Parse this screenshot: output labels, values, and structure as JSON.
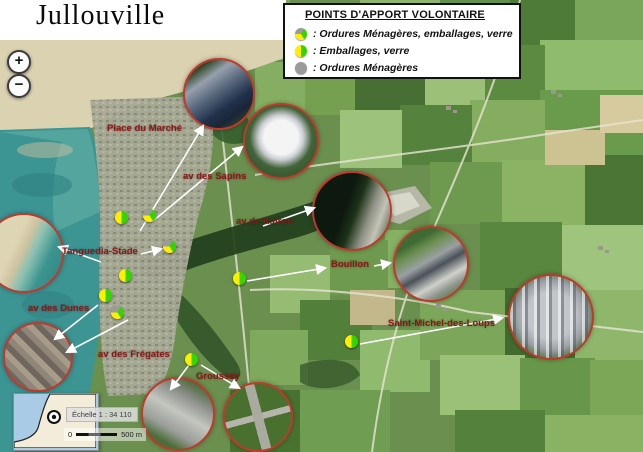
{
  "title": "Jullouville",
  "legend": {
    "title": "POINTS D'APPORT VOLONTAIRE",
    "items": [
      {
        "icon": "pie-grey-yellow-green",
        "label": ": Ordures Ménagères, emballages, verre"
      },
      {
        "icon": "pie-yellow-green",
        "label": ": Emballages, verre"
      },
      {
        "icon": "circle-grey",
        "label": ": Ordures Ménagères"
      }
    ]
  },
  "zoom_controls": {
    "zoom_in_label": "+",
    "zoom_out_label": "−"
  },
  "map": {
    "labels": [
      {
        "text": "Place du Marché"
      },
      {
        "text": "av des Sapins"
      },
      {
        "text": "av de Kairon"
      },
      {
        "text": "Tanguedia-Stade"
      },
      {
        "text": "Bouillon"
      },
      {
        "text": "av des Dunes"
      },
      {
        "text": "av des Frégates"
      },
      {
        "text": "Groussey"
      },
      {
        "text": "Saint-Michel-des-Loups"
      }
    ],
    "markers": [
      {
        "type": "emballages-verre"
      },
      {
        "type": "ordures-emballages-verre"
      },
      {
        "type": "ordures-emballages-verre"
      },
      {
        "type": "emballages-verre"
      },
      {
        "type": "emballages-verre"
      },
      {
        "type": "ordures-emballages-verre"
      },
      {
        "type": "emballages-verre"
      },
      {
        "type": "emballages-verre"
      },
      {
        "type": "emballages-verre"
      }
    ]
  },
  "scale": {
    "text": "Échelle 1 : 34 110",
    "bar_start": "0",
    "bar_end": "500 m"
  },
  "colors": {
    "inset_border_red": "#c0392b",
    "label_red": "#8e1616",
    "pie_yellow": "#ffee00",
    "pie_green": "#33d400",
    "pie_grey": "#9a9a9a",
    "sea_teal": "#3c9493"
  }
}
